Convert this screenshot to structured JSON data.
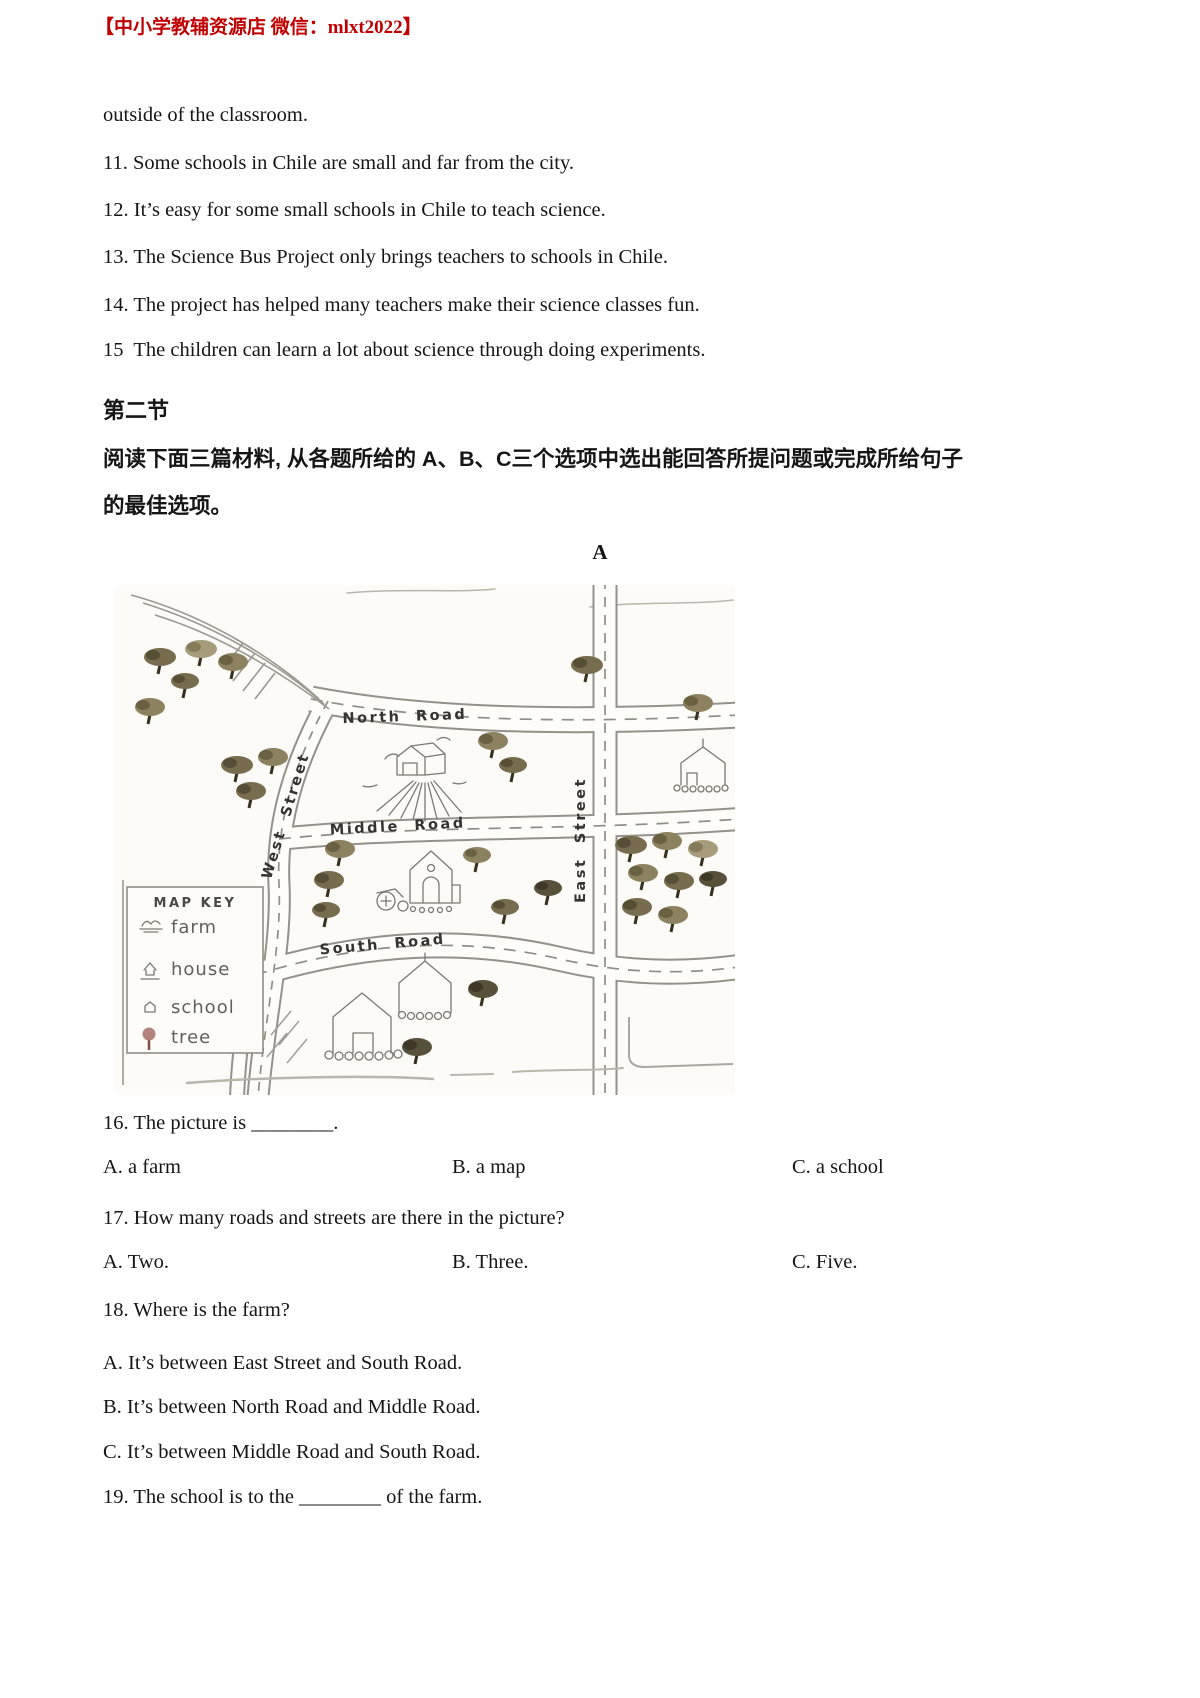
{
  "header": {
    "store_banner": "【中小学教辅资源店 微信：mlxt2022】"
  },
  "passage": {
    "intro_line": "outside of the classroom.",
    "statements": [
      "11. Some schools in Chile are small and far from the city.",
      "12. It’s easy for some small schools in Chile to teach science.",
      "13. The Science Bus Project only brings teachers to schools in Chile.",
      "14. The project has helped many teachers make their science classes fun.",
      "15  The children can learn a lot about science through doing experiments."
    ]
  },
  "section": {
    "title": "第二节",
    "instructions_line1": "阅读下面三篇材料, 从各题所给的 A、B、C三个选项中选出能回答所提问题或完成所给句子",
    "instructions_line2": "的最佳选项。",
    "passage_label": "A"
  },
  "map": {
    "roads": {
      "north": "North Road",
      "middle": "Middle Road",
      "south": "South Road",
      "west": "West Street",
      "east": "East Street"
    },
    "key": {
      "title": "MAP KEY",
      "items": [
        "farm",
        "house",
        "school",
        "tree"
      ]
    }
  },
  "questions": [
    {
      "text": "16. The picture is ________.",
      "options": [
        "A. a farm",
        "B. a map",
        "C. a school"
      ]
    },
    {
      "text": "17. How many roads and streets are there in the picture?",
      "options": [
        "A. Two.",
        "B. Three.",
        "C. Five."
      ]
    },
    {
      "text": "18. Where is the farm?",
      "options": [
        "A. It’s between East Street and South Road.",
        "B. It’s between North Road and Middle Road.",
        "C. It’s between Middle Road and South Road."
      ]
    },
    {
      "text": "19. The school is to the ________ of the farm."
    }
  ]
}
